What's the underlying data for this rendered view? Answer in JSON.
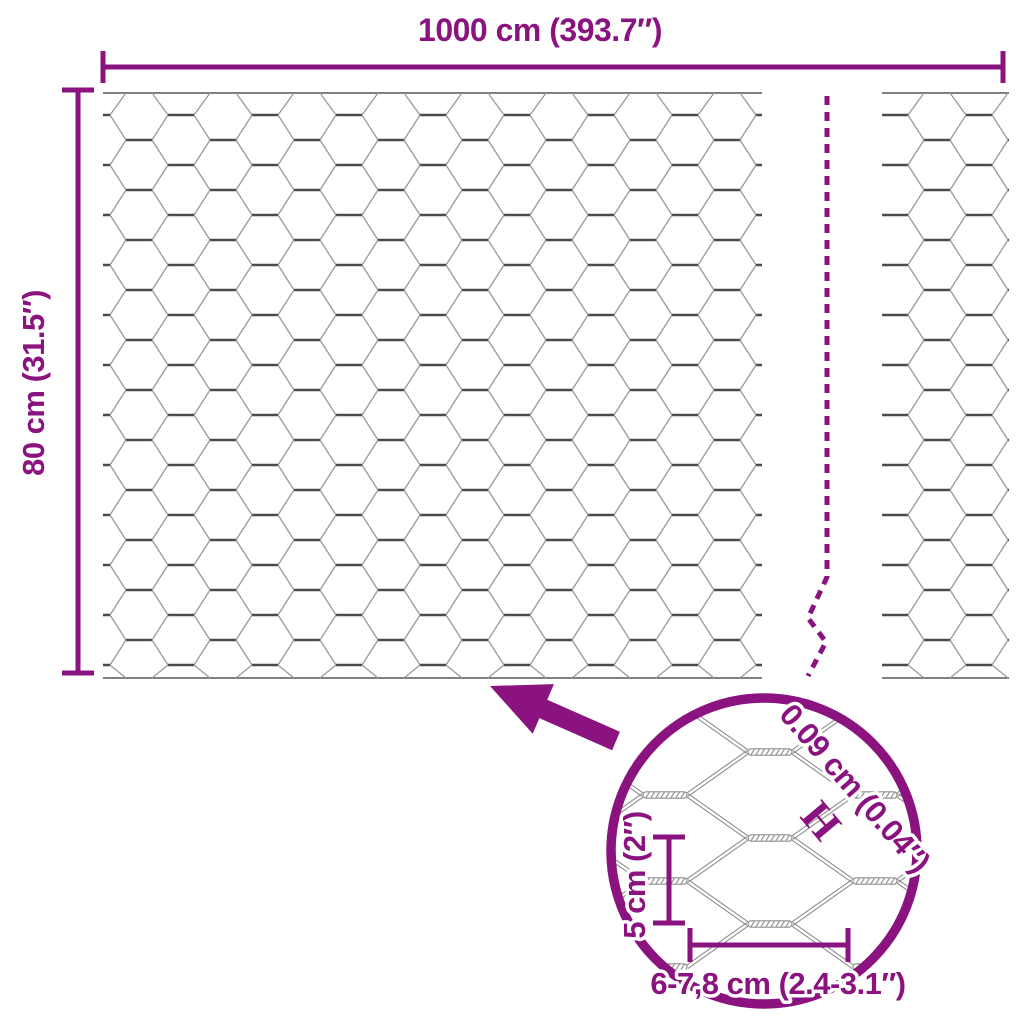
{
  "colors": {
    "accent": "#8a1380",
    "mesh_diagonal": "#9a9a9a",
    "mesh_twist": "#4a4a4a",
    "mesh_edge": "#6e6e6e",
    "detail_wire": "#8d8d8d",
    "background": "#ffffff"
  },
  "top_dimension": {
    "label": "1000 cm (393.7″)"
  },
  "left_dimension": {
    "label": "80 cm (31.5″)"
  },
  "detail_view": {
    "wire_thickness_label": "0.09 cm (0.04″)",
    "wire_thickness_marker": "H",
    "cell_height_label": "5 cm (2″)",
    "cell_width_label": "6-7,8 cm (2.4-3.1″)"
  }
}
